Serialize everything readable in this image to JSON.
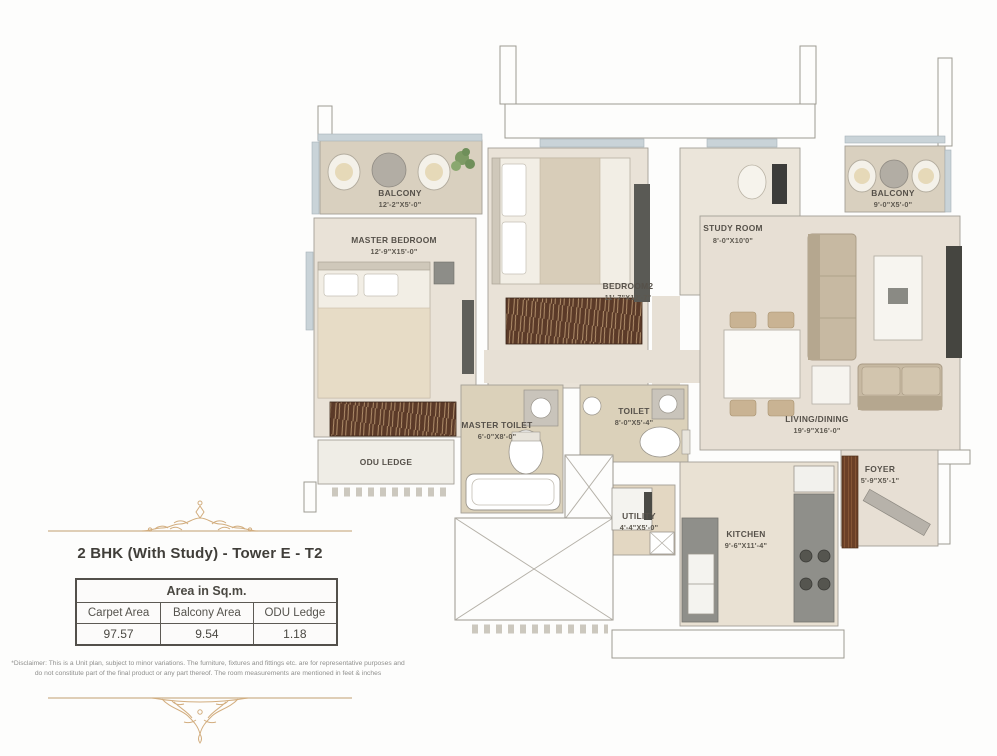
{
  "title": "2 BHK (With Study) - Tower E - T2",
  "area_table": {
    "header": "Area in Sq.m.",
    "columns": [
      "Carpet Area",
      "Balcony Area",
      "ODU Ledge"
    ],
    "values": [
      "97.57",
      "9.54",
      "1.18"
    ]
  },
  "disclaimer": "*Disclaimer: This is a Unit plan, subject to minor variations. The furniture, fixtures and fittings etc. are for representative purposes and do not constitute part of the final product or any part thereof. The room measurements are mentioned in feet & inches",
  "rooms": [
    {
      "id": "balcony-left",
      "name": "BALCONY",
      "dims": "12'-2\"X5'-0\""
    },
    {
      "id": "master-bedroom",
      "name": "MASTER BEDROOM",
      "dims": "12'-9\"X15'-0\""
    },
    {
      "id": "bedroom2",
      "name": "BEDROOM2",
      "dims": "11'-7\"X12'-7\""
    },
    {
      "id": "study-room",
      "name": "STUDY ROOM",
      "dims": "8'-0\"X10'0\""
    },
    {
      "id": "balcony-right",
      "name": "BALCONY",
      "dims": "9'-0\"X5'-0\""
    },
    {
      "id": "living-dining",
      "name": "LIVING/DINING",
      "dims": "19'-9\"X16'-0\""
    },
    {
      "id": "master-toilet",
      "name": "MASTER TOILET",
      "dims": "6'-0\"X8'-0\""
    },
    {
      "id": "toilet",
      "name": "TOILET",
      "dims": "8'-0\"X5'-4\""
    },
    {
      "id": "odu-ledge",
      "name": "ODU LEDGE",
      "dims": ""
    },
    {
      "id": "utility",
      "name": "UTILITY",
      "dims": "4'-4\"X5'-0\""
    },
    {
      "id": "kitchen",
      "name": "KITCHEN",
      "dims": "9'-6\"X11'-4\""
    },
    {
      "id": "foyer",
      "name": "FOYER",
      "dims": "5'-9\"X5'-1\""
    }
  ],
  "colors": {
    "accent_gold": "#cfa977",
    "wall_line": "#9d9a92",
    "floor_room": "#e9e2d7",
    "floor_balcony": "#d9d0bf",
    "floor_toilet": "#dbd1ba",
    "wood_wardrobe": "#5b3a28",
    "kitchen_counter": "#8f8f8a",
    "label_text": "#56514a"
  }
}
